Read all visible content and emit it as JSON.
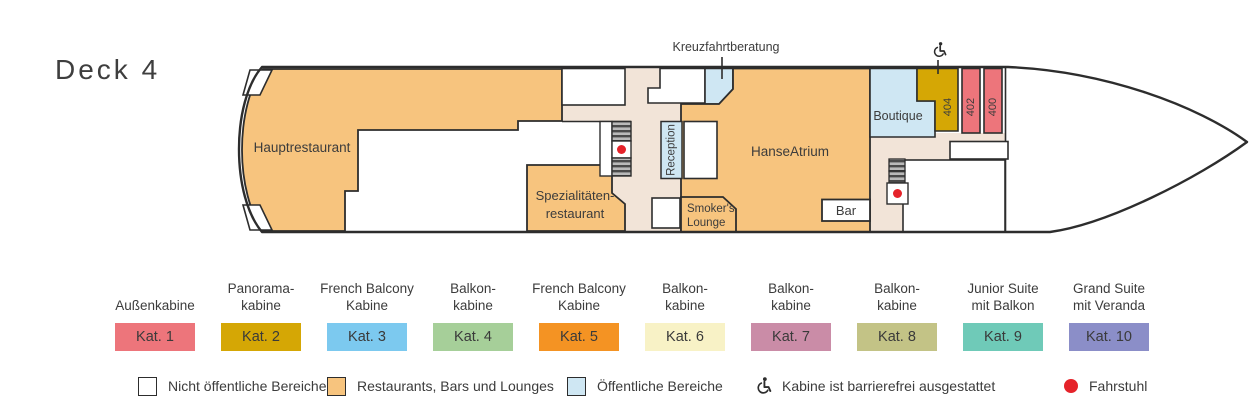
{
  "title": "Deck 4",
  "ship": {
    "rooms": {
      "hauptrestaurant": "Hauptrestaurant",
      "spezialitaeten_line1": "Spezialitäten-",
      "spezialitaeten_line2": "restaurant",
      "reception": "Reception",
      "kreuzfahrtberatung": "Kreuzfahrtberatung",
      "smokers_line1": "Smoker's",
      "smokers_line2": "Lounge",
      "hanseatrium": "HanseAtrium",
      "bar": "Bar",
      "boutique": "Boutique",
      "cabin_404": "404",
      "cabin_402": "402",
      "cabin_400": "400"
    }
  },
  "categories": [
    {
      "line1": "",
      "line2": "Außenkabine",
      "kat": "Kat. 1",
      "color": "#ed757b"
    },
    {
      "line1": "Panorama-",
      "line2": "kabine",
      "kat": "Kat. 2",
      "color": "#d5a705"
    },
    {
      "line1": "French Balcony",
      "line2": "Kabine",
      "kat": "Kat. 3",
      "color": "#7cc9ef"
    },
    {
      "line1": "Balkon-",
      "line2": "kabine",
      "kat": "Kat. 4",
      "color": "#a6cf99"
    },
    {
      "line1": "French Balcony",
      "line2": "Kabine",
      "kat": "Kat. 5",
      "color": "#f49323"
    },
    {
      "line1": "Balkon-",
      "line2": "kabine",
      "kat": "Kat. 6",
      "color": "#f8f2c6"
    },
    {
      "line1": "Balkon-",
      "line2": "kabine",
      "kat": "Kat. 7",
      "color": "#ca8ca7"
    },
    {
      "line1": "Balkon-",
      "line2": "kabine",
      "kat": "Kat. 8",
      "color": "#c3c386"
    },
    {
      "line1": "Junior Suite",
      "line2": "mit Balkon",
      "kat": "Kat. 9",
      "color": "#6fcab8"
    },
    {
      "line1": "Grand Suite",
      "line2": "mit Veranda",
      "kat": "Kat. 10",
      "color": "#8b8ec8"
    }
  ],
  "legend": {
    "non_public": "Nicht öffentliche Bereiche",
    "restaurants": "Restaurants, Bars und Lounges",
    "public": "Öffentliche Bereiche",
    "accessible": "Kabine ist barrierefrei ausgestattet",
    "elevator": "Fahrstuhl"
  },
  "colors": {
    "restaurants_bars_lounges": "#f7c47e",
    "public_areas": "#cfe7f3",
    "corridor": "#f2e4d8",
    "non_public": "#ffffff",
    "elevator_dot": "#e5232a",
    "outline": "#2d2d2d",
    "cabin_kat1": "#ed757b",
    "cabin_kat2": "#d5a705"
  }
}
